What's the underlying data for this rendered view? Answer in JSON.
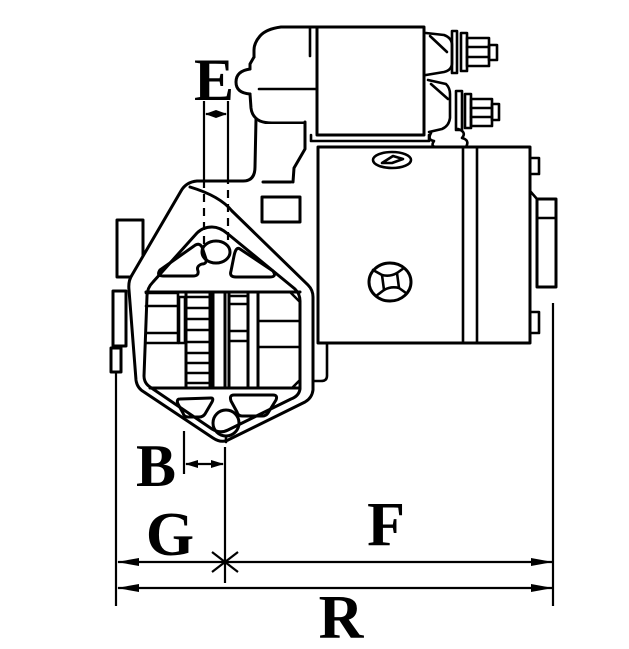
{
  "drawing": {
    "subject": "Starter motor side-view outline technical drawing with dimension callouts",
    "type": "technical-line-drawing",
    "colors": {
      "line": "#000000",
      "background": "#ffffff"
    },
    "dimension_labels": {
      "e": "E",
      "b": "B",
      "g": "G",
      "f": "F",
      "r": "R"
    }
  }
}
